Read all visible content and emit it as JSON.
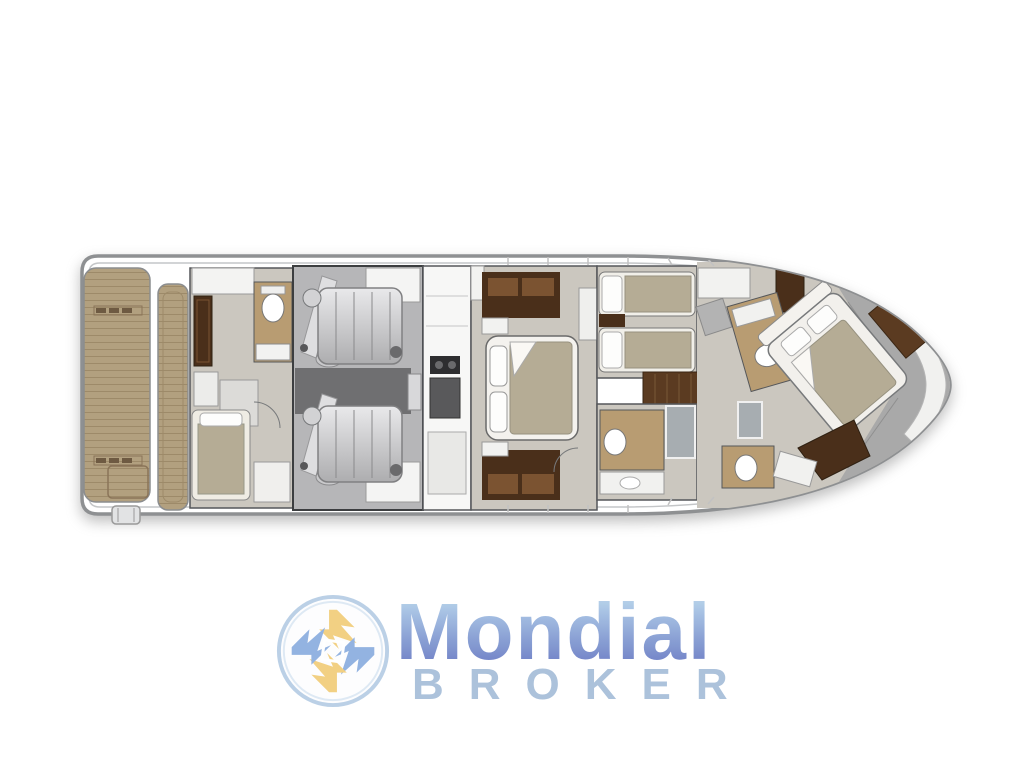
{
  "logo": {
    "brand": "Mondial",
    "subtitle": "BROKER",
    "brand_gradient_top": "#bcdaee",
    "brand_gradient_bottom": "#6e80c6",
    "subtitle_color": "#a9c0da",
    "emblem_yellow": "#f2cf7e",
    "emblem_blue": "#8fb0e0",
    "emblem_ring": "#b9cfe6"
  },
  "palette": {
    "hull_outline": "#8e9092",
    "hull_inner_line": "#c4c6c8",
    "teak": "#b2a07f",
    "teak_grain": "#9d8a69",
    "wood_floor": "#b89c72",
    "cabin_floor": "#cbc7bf",
    "dark_wood": "#4a2f1a",
    "corridor_wood": "#5b3b21",
    "engine_room": "#b6b6b8",
    "engine_aisle": "#6f6f71",
    "bow_deck": "#a9a9a9",
    "mattress": "#b5ac95",
    "shower_gray": "#a7adb1",
    "white_furniture": "#f4f4f3"
  }
}
